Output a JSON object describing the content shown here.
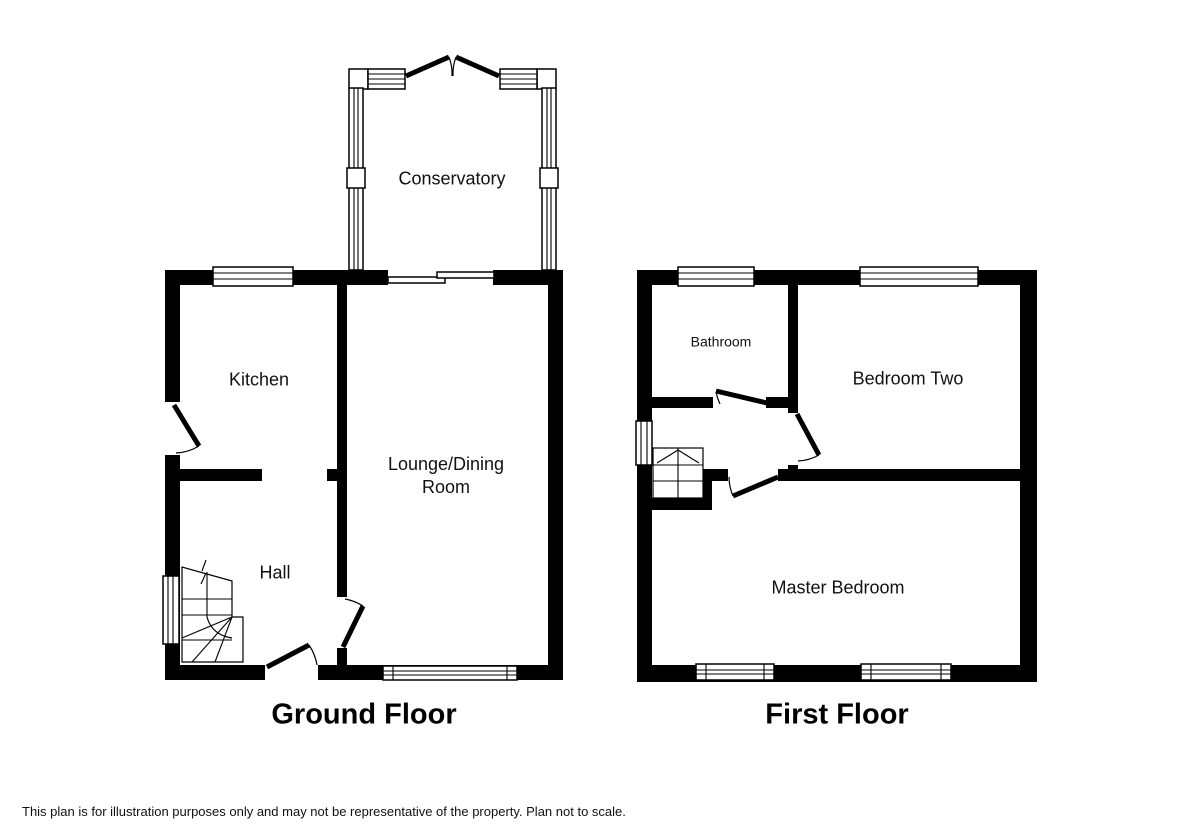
{
  "plan": {
    "background": "#ffffff",
    "line_color": "#000000",
    "floors": [
      {
        "title": "Ground Floor",
        "rooms": {
          "conservatory": "Conservatory",
          "kitchen": "Kitchen",
          "lounge": {
            "line1": "Lounge/Dining",
            "line2": "Room"
          },
          "hall": "Hall"
        }
      },
      {
        "title": "First Floor",
        "rooms": {
          "bathroom": "Bathroom",
          "bedroom_two": "Bedroom Two",
          "master_bedroom": "Master Bedroom"
        }
      }
    ],
    "disclaimer": "This plan is for illustration purposes only and may not be representative of the property. Plan not to scale."
  }
}
